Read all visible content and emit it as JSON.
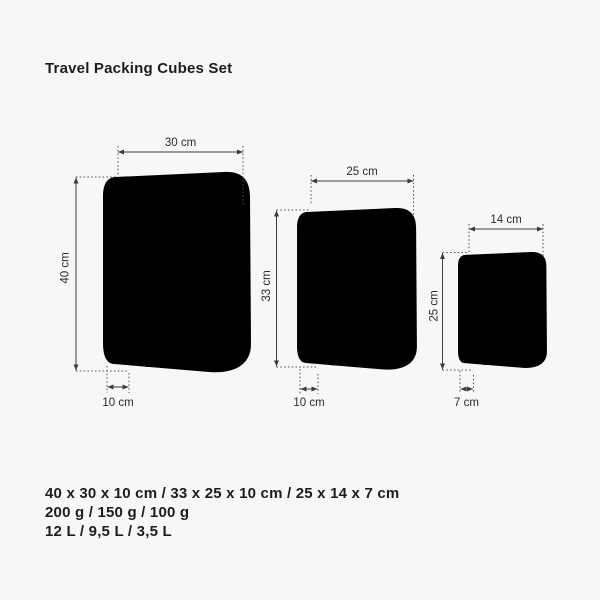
{
  "title": "Travel Packing Cubes Set",
  "cubes": [
    {
      "id": "large",
      "width": "30 cm",
      "height": "40 cm",
      "depth": "10 cm"
    },
    {
      "id": "medium",
      "width": "25 cm",
      "height": "33 cm",
      "depth": "10 cm"
    },
    {
      "id": "small",
      "width": "14 cm",
      "height": "25 cm",
      "depth": "7 cm"
    }
  ],
  "specs": {
    "dimensions": "40 x 30 x 10 cm / 33 x 25 x 10 cm / 25 x 14 x 7 cm",
    "weights": "200 g / 150 g / 100 g",
    "volumes": "12 L / 9,5 L / 3,5 L"
  },
  "colors": {
    "background": "#f7f7f7",
    "outline": "#909090",
    "dimension_line": "#3c3c3c",
    "text": "#1d1d1f"
  }
}
